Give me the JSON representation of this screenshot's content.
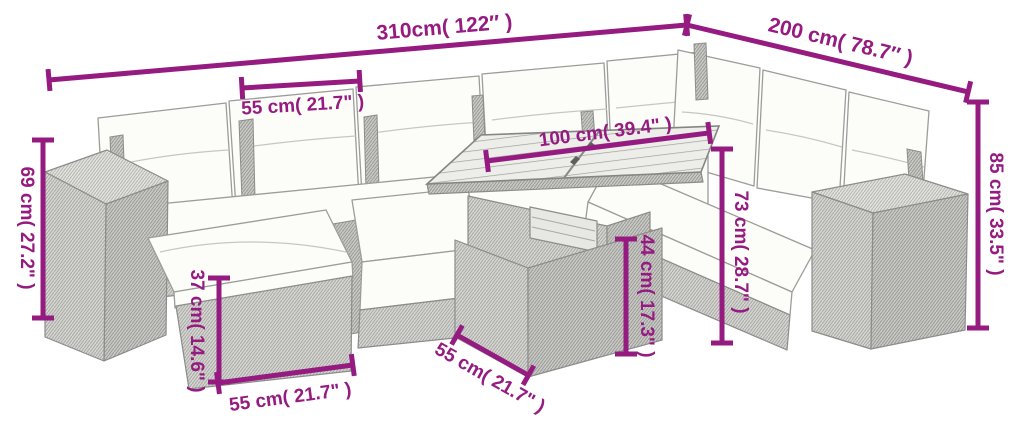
{
  "diagram": {
    "accent_color": "#951b81",
    "background_color": "#ffffff",
    "labels": {
      "overall_width": "310cm( 122″ )",
      "overall_depth": "200 cm( 78.7″ )",
      "back_cushion_width": "55 cm( 21.7\" )",
      "side_table_height": "69 cm( 27.2\" )",
      "total_height": "85 cm( 33.5\" )",
      "table_top_length": "100 cm( 39.4\" )",
      "backrest_height": "73 cm( 28.7\" )",
      "table_height": "44 cm( 17.3\" )",
      "footstool_height": "37 cm( 14.6\" )",
      "footstool_width": "55 cm( 21.7\" )",
      "table_top_depth": "55 cm( 21.7\" )"
    }
  }
}
